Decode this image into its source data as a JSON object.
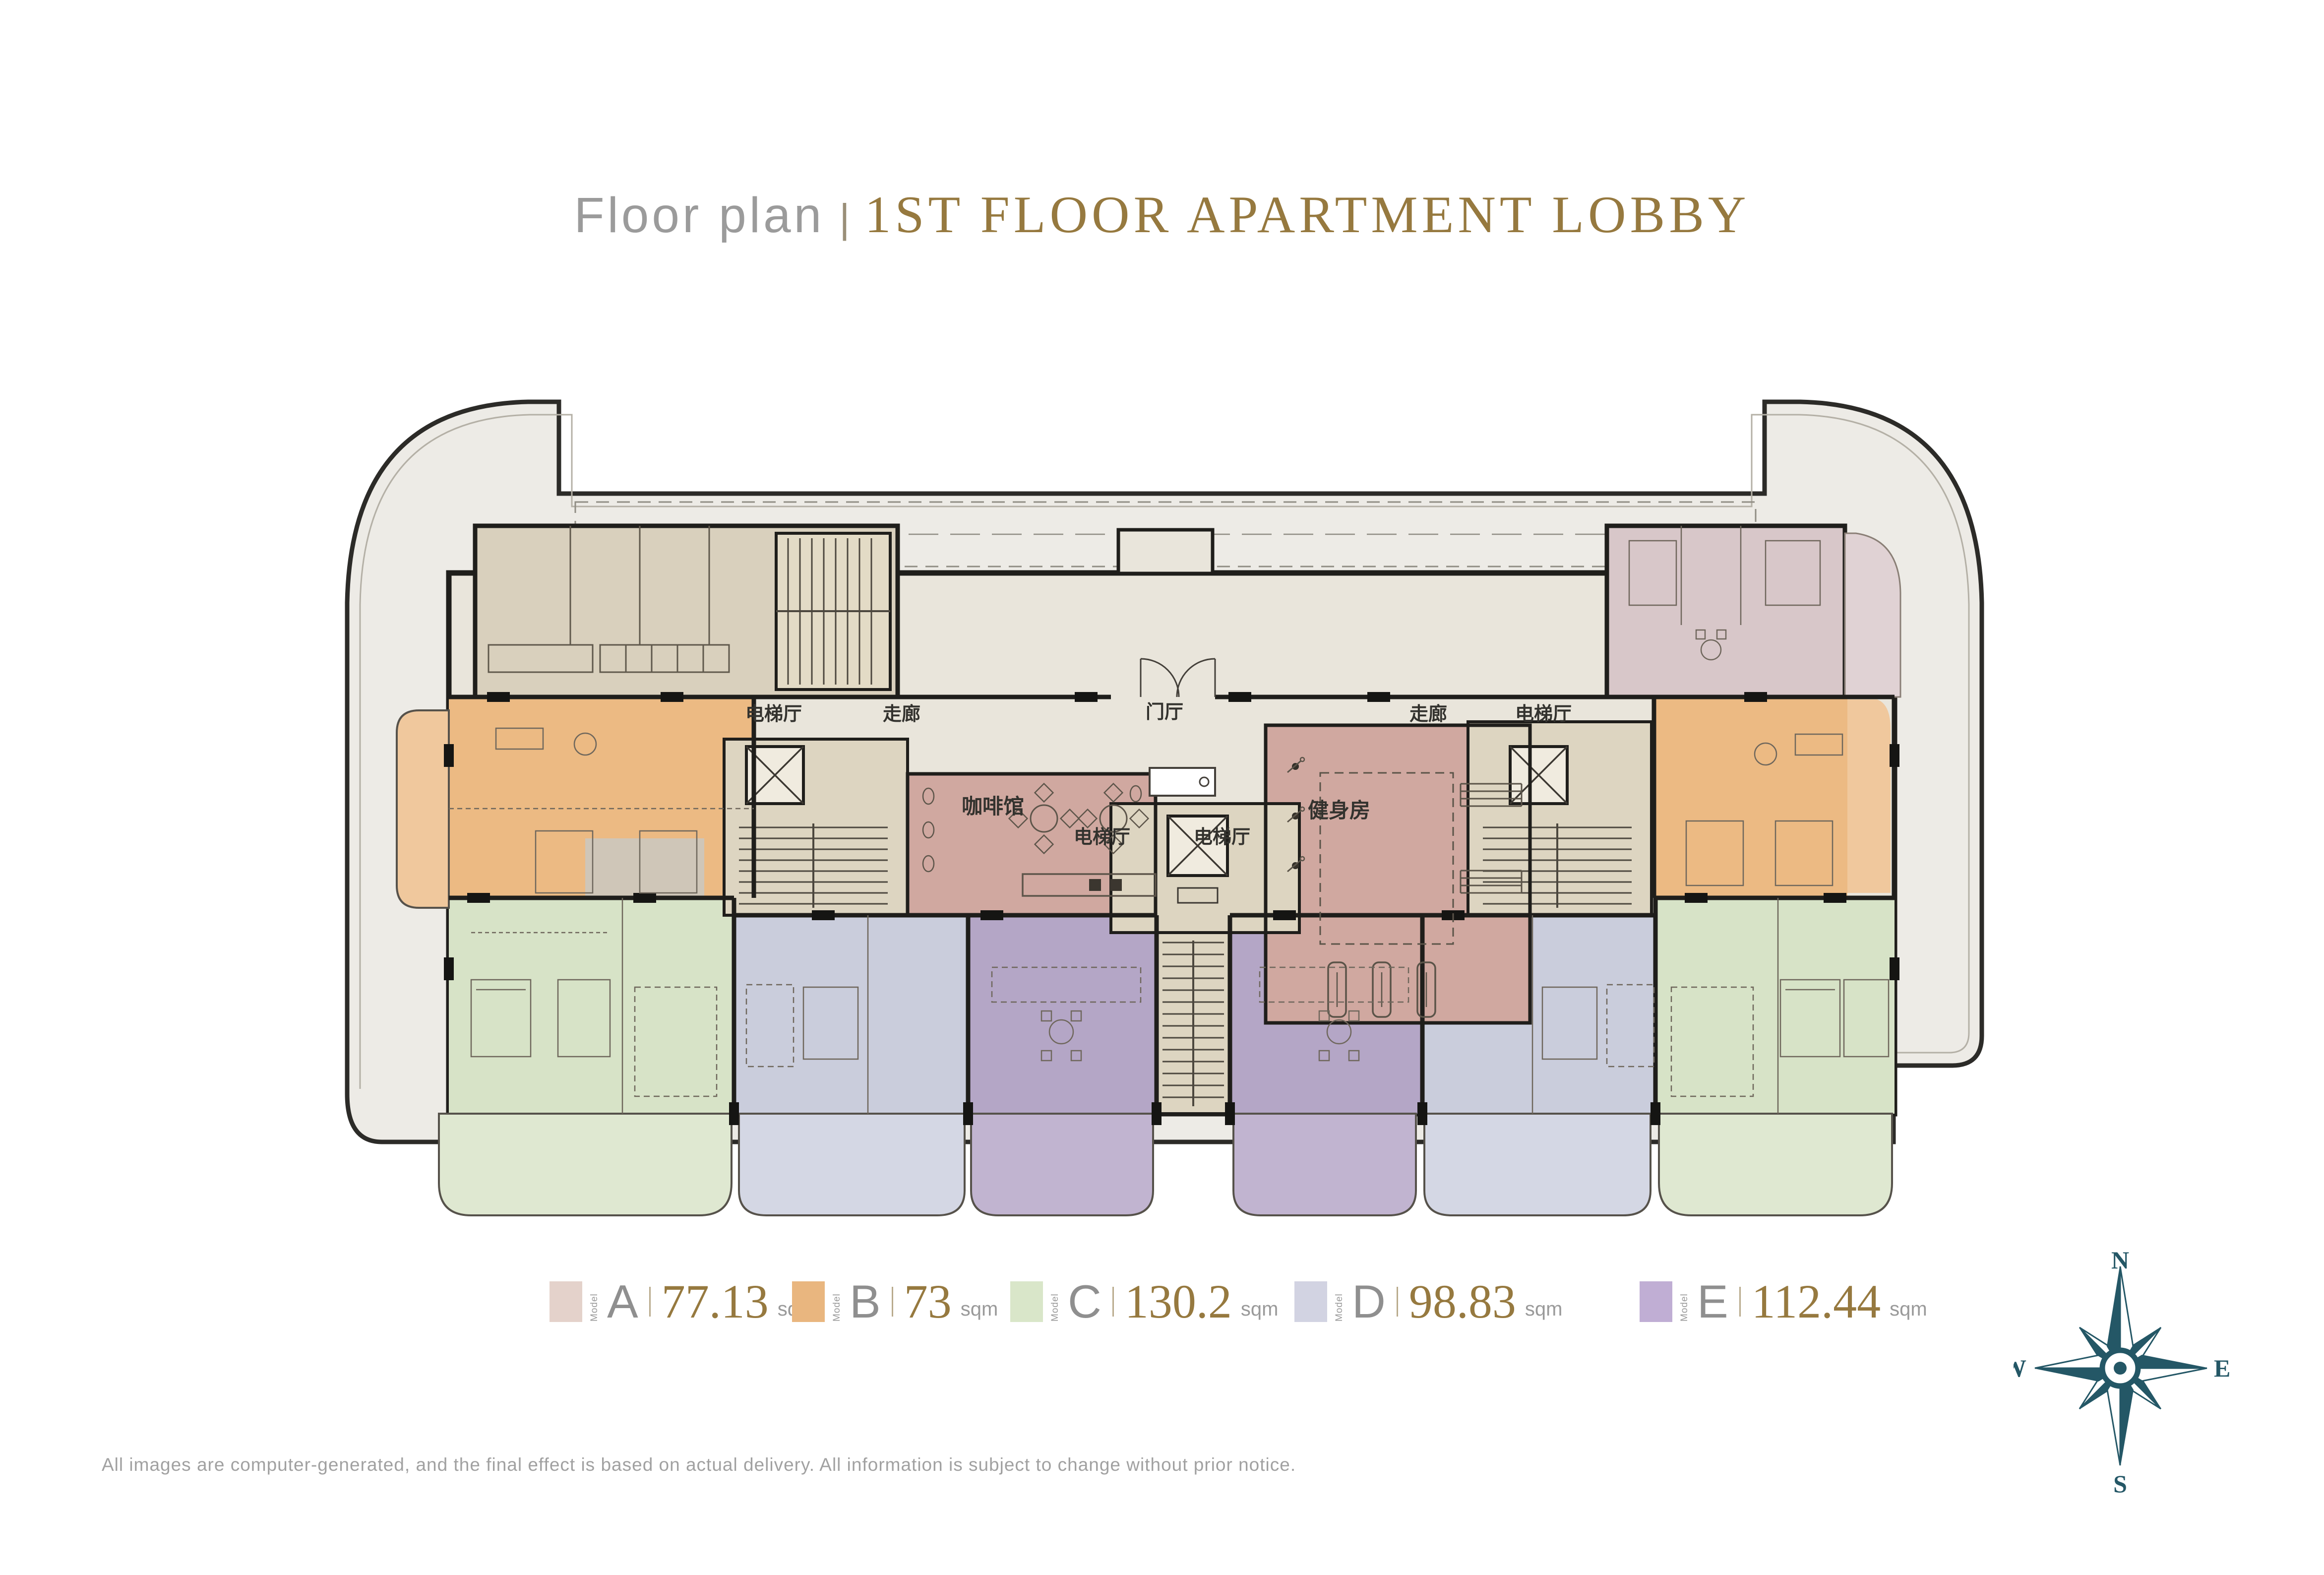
{
  "page": {
    "background": "#ffffff"
  },
  "title": {
    "prefix": "Floor plan",
    "divider": "|",
    "main": "1ST FLOOR APARTMENT LOBBY",
    "prefix_color": "#9b9b9b",
    "accent_color": "#96793f"
  },
  "floorplan": {
    "rooms": [
      {
        "name": "elevator-hall-left",
        "label": "电梯厅"
      },
      {
        "name": "corridor-left",
        "label": "走廊"
      },
      {
        "name": "entrance-hall",
        "label": "门厅"
      },
      {
        "name": "corridor-right",
        "label": "走廊"
      },
      {
        "name": "elevator-hall-right",
        "label": "电梯厅"
      },
      {
        "name": "cafe",
        "label": "咖啡馆"
      },
      {
        "name": "elevator-hall-center-left",
        "label": "电梯厅"
      },
      {
        "name": "elevator-hall-center-right",
        "label": "电梯厅"
      },
      {
        "name": "gym",
        "label": "健身房"
      }
    ],
    "palette": {
      "site": "#edebe6",
      "building": "#e9e5db",
      "core": "#ddd5c1",
      "service_block": "#d9d0bd",
      "unit_a": "#d8c7c9",
      "unit_b": "#ecba83",
      "unit_c": "#d7e3c7",
      "unit_d": "#cacddc",
      "unit_e": "#b4a6c6",
      "amenity": "#d0a8a0",
      "wall": "#1f1e1b"
    }
  },
  "legend": {
    "label_prefix": "Model",
    "unit": "sqm",
    "items": [
      {
        "id": "A",
        "area": "77.13",
        "color": "#e4d2cb"
      },
      {
        "id": "B",
        "area": "73",
        "color": "#e9b67f"
      },
      {
        "id": "C",
        "area": "130.2",
        "color": "#d9e6c9"
      },
      {
        "id": "D",
        "area": "98.83",
        "color": "#d2d3e2"
      },
      {
        "id": "E",
        "area": "112.44",
        "color": "#c0aed4"
      }
    ]
  },
  "compass": {
    "n": "N",
    "e": "E",
    "s": "S",
    "w": "W",
    "color": "#245766"
  },
  "disclaimer": {
    "text": "All images are computer-generated, and the final effect is based on actual delivery. All information is subject to change without prior notice."
  }
}
